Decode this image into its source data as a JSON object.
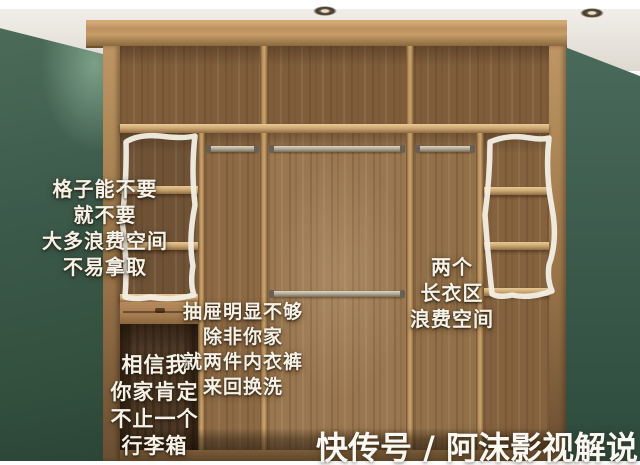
{
  "annotations": {
    "grid_note": {
      "lines": [
        "格子能不要",
        "就不要",
        "大多浪费空间",
        "不易拿取"
      ]
    },
    "drawer_note": {
      "lines": [
        "抽屉明显不够",
        "除非你家",
        "就两件内衣裤",
        "来回换洗"
      ]
    },
    "luggage_note": {
      "lines": [
        "相信我",
        "你家肯定",
        "不止一个",
        "行李箱"
      ]
    },
    "long_hang_note": {
      "lines": [
        "两个",
        "长衣区",
        "浪费空间"
      ]
    },
    "watermark": "快传号 / 阿沫影视解说"
  },
  "colors": {
    "wall_green": "#3c5a4b",
    "ceiling": "#ded9d0",
    "wood_face": "#bb9260",
    "wood_back": "#8f6c48",
    "wood_dark": "#4e3a26",
    "highlight_stroke": "#f2eee3",
    "text_white": "#f6f2e8"
  }
}
